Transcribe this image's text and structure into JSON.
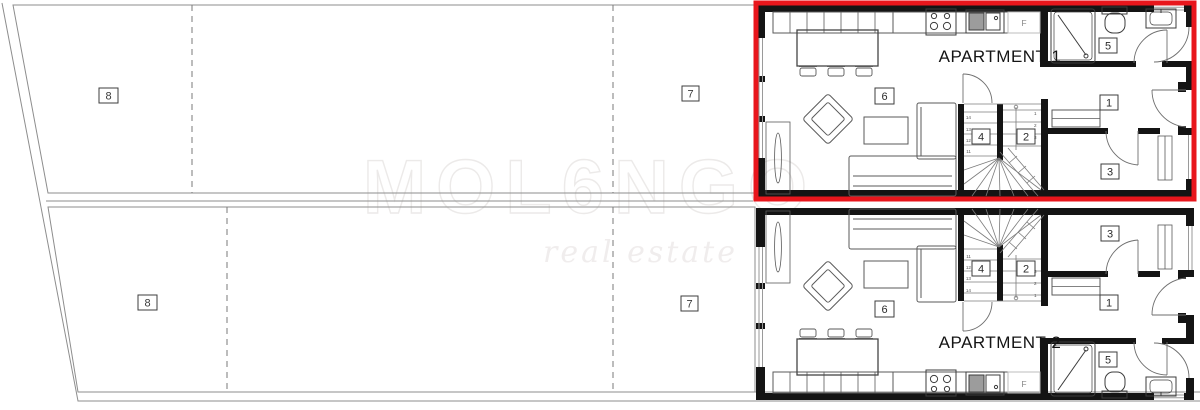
{
  "title": "Duplex floor plan with garden plots",
  "colors": {
    "highlight_red": "#e8161c",
    "wall_black": "#141414",
    "furniture_line": "#5a5a5a",
    "thin_line": "#8f8f8f",
    "watermark": "#eceae9",
    "sink_fill": "#9c9c9c"
  },
  "watermark": {
    "brand": "MOL6NGO",
    "tagline": "real estate"
  },
  "plots": {
    "top": {
      "left_label": "8",
      "right_label": "7"
    },
    "bottom": {
      "left_label": "8",
      "right_label": "7"
    }
  },
  "apartments": [
    {
      "name": "APARTMENT 1",
      "room_labels": {
        "living": "6",
        "stair_a": "4",
        "stair_b": "2",
        "bath": "5",
        "hall": "1",
        "bedroom": "3"
      },
      "fridge": "F",
      "stair_numbers_left": [
        "14",
        "13",
        "12",
        "11"
      ],
      "stair_numbers_right": [
        "1",
        "2",
        "3"
      ]
    },
    {
      "name": "APARTMENT 2",
      "room_labels": {
        "living": "6",
        "stair_a": "4",
        "stair_b": "2",
        "bath": "5",
        "hall": "1",
        "bedroom": "3"
      },
      "fridge": "F",
      "stair_numbers_left": [
        "14",
        "13",
        "12",
        "11"
      ],
      "stair_numbers_right": [
        "1",
        "2",
        "3"
      ]
    }
  ]
}
